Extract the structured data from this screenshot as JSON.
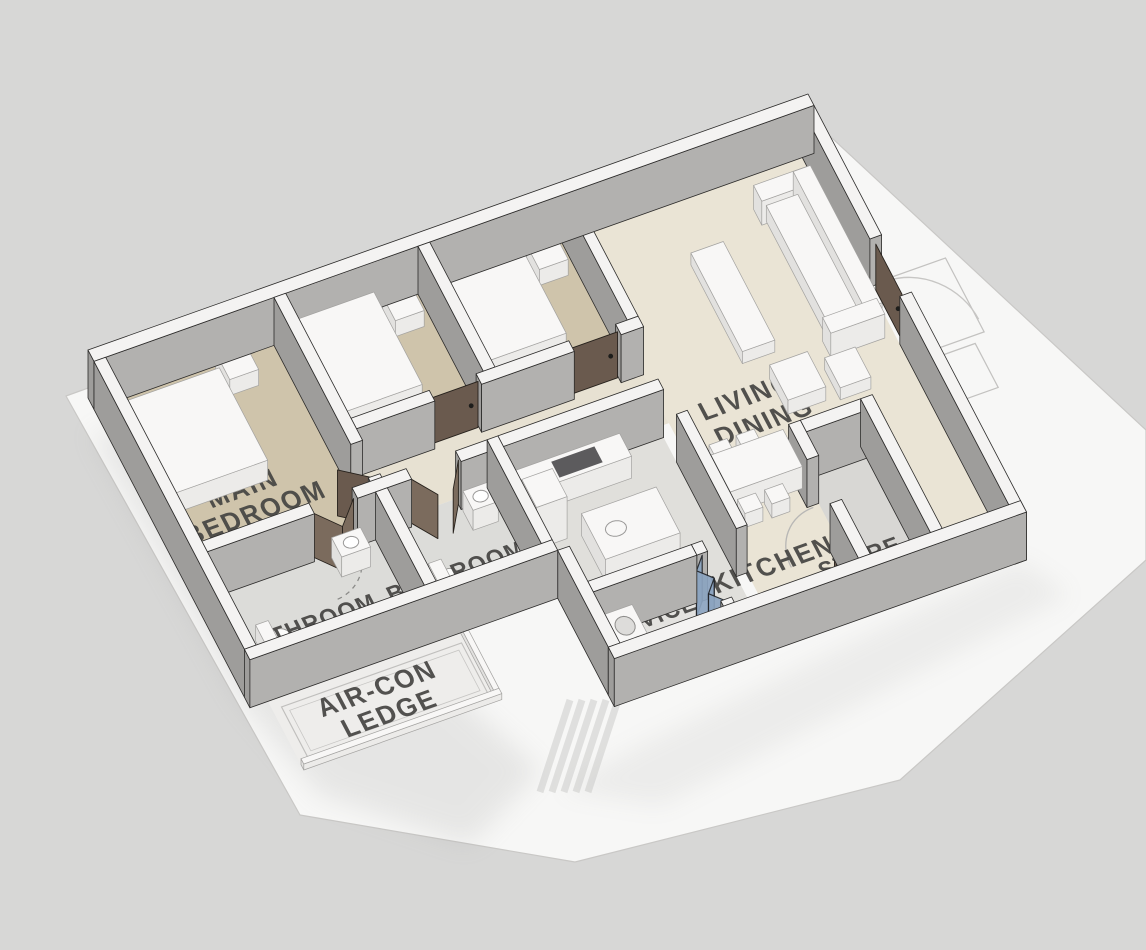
{
  "scene": {
    "type": "3d-axonometric-floor-plan",
    "description": "Isometric 3D floor plan model of a 3-bedroom apartment on a white base slab"
  },
  "labels": {
    "main_bedroom": {
      "line1": "MAIN",
      "line2": "BEDROOM"
    },
    "bathroom_main": {
      "line1": "BATHROOM"
    },
    "bathroom_common": {
      "line1": "BATHROOM"
    },
    "living_dining": {
      "line1": "LIVING/",
      "line2": "DINING"
    },
    "kitchen": {
      "line1": "KITCHEN"
    },
    "service_yard": {
      "line1": "SERVICE",
      "line2": "YARD"
    },
    "aircon_ledge": {
      "line1": "AIR-CON",
      "line2": "LEDGE"
    },
    "store_shelter": {
      "line1": "STORE-",
      "line2": "SHELTER"
    }
  },
  "colors": {
    "background": "#d7d7d6",
    "slab": "#f7f7f6",
    "slab_edge": "#c9c8c6",
    "wall_top": "#f4f3f2",
    "wall_face_south": "#b2b1af",
    "wall_face_west": "#9e9d9b",
    "outline": "#2c2b2a",
    "floor_bedroom": "#cfc4ab",
    "floor_living": "#eae4d5",
    "floor_hall": "#e7e1d2",
    "floor_bath": "#dcdcd9",
    "floor_kitchen": "#e0dfdb",
    "floor_yard": "#e3e2df",
    "floor_store": "#d8d7d4",
    "floor_ledge": "#eeedeb",
    "furniture_top": "#f8f7f6",
    "furniture_side": "#ecebe9",
    "furniture_west": "#e2e1df",
    "furniture_outline": "#a3a2a0",
    "door": "#6a5a4e",
    "door_light": "#7b6b5d",
    "door_outline": "#26211c",
    "window_frame": "#17181a",
    "window_pane": "#3f444b",
    "bath_window_frame": "#f0efed",
    "bath_window_pane": "#4c5055",
    "glass_blue": "#8ca4c0",
    "swing_arc": "#c7c6c4",
    "label_text": "#454442",
    "shadow": "#8f8f8d"
  }
}
